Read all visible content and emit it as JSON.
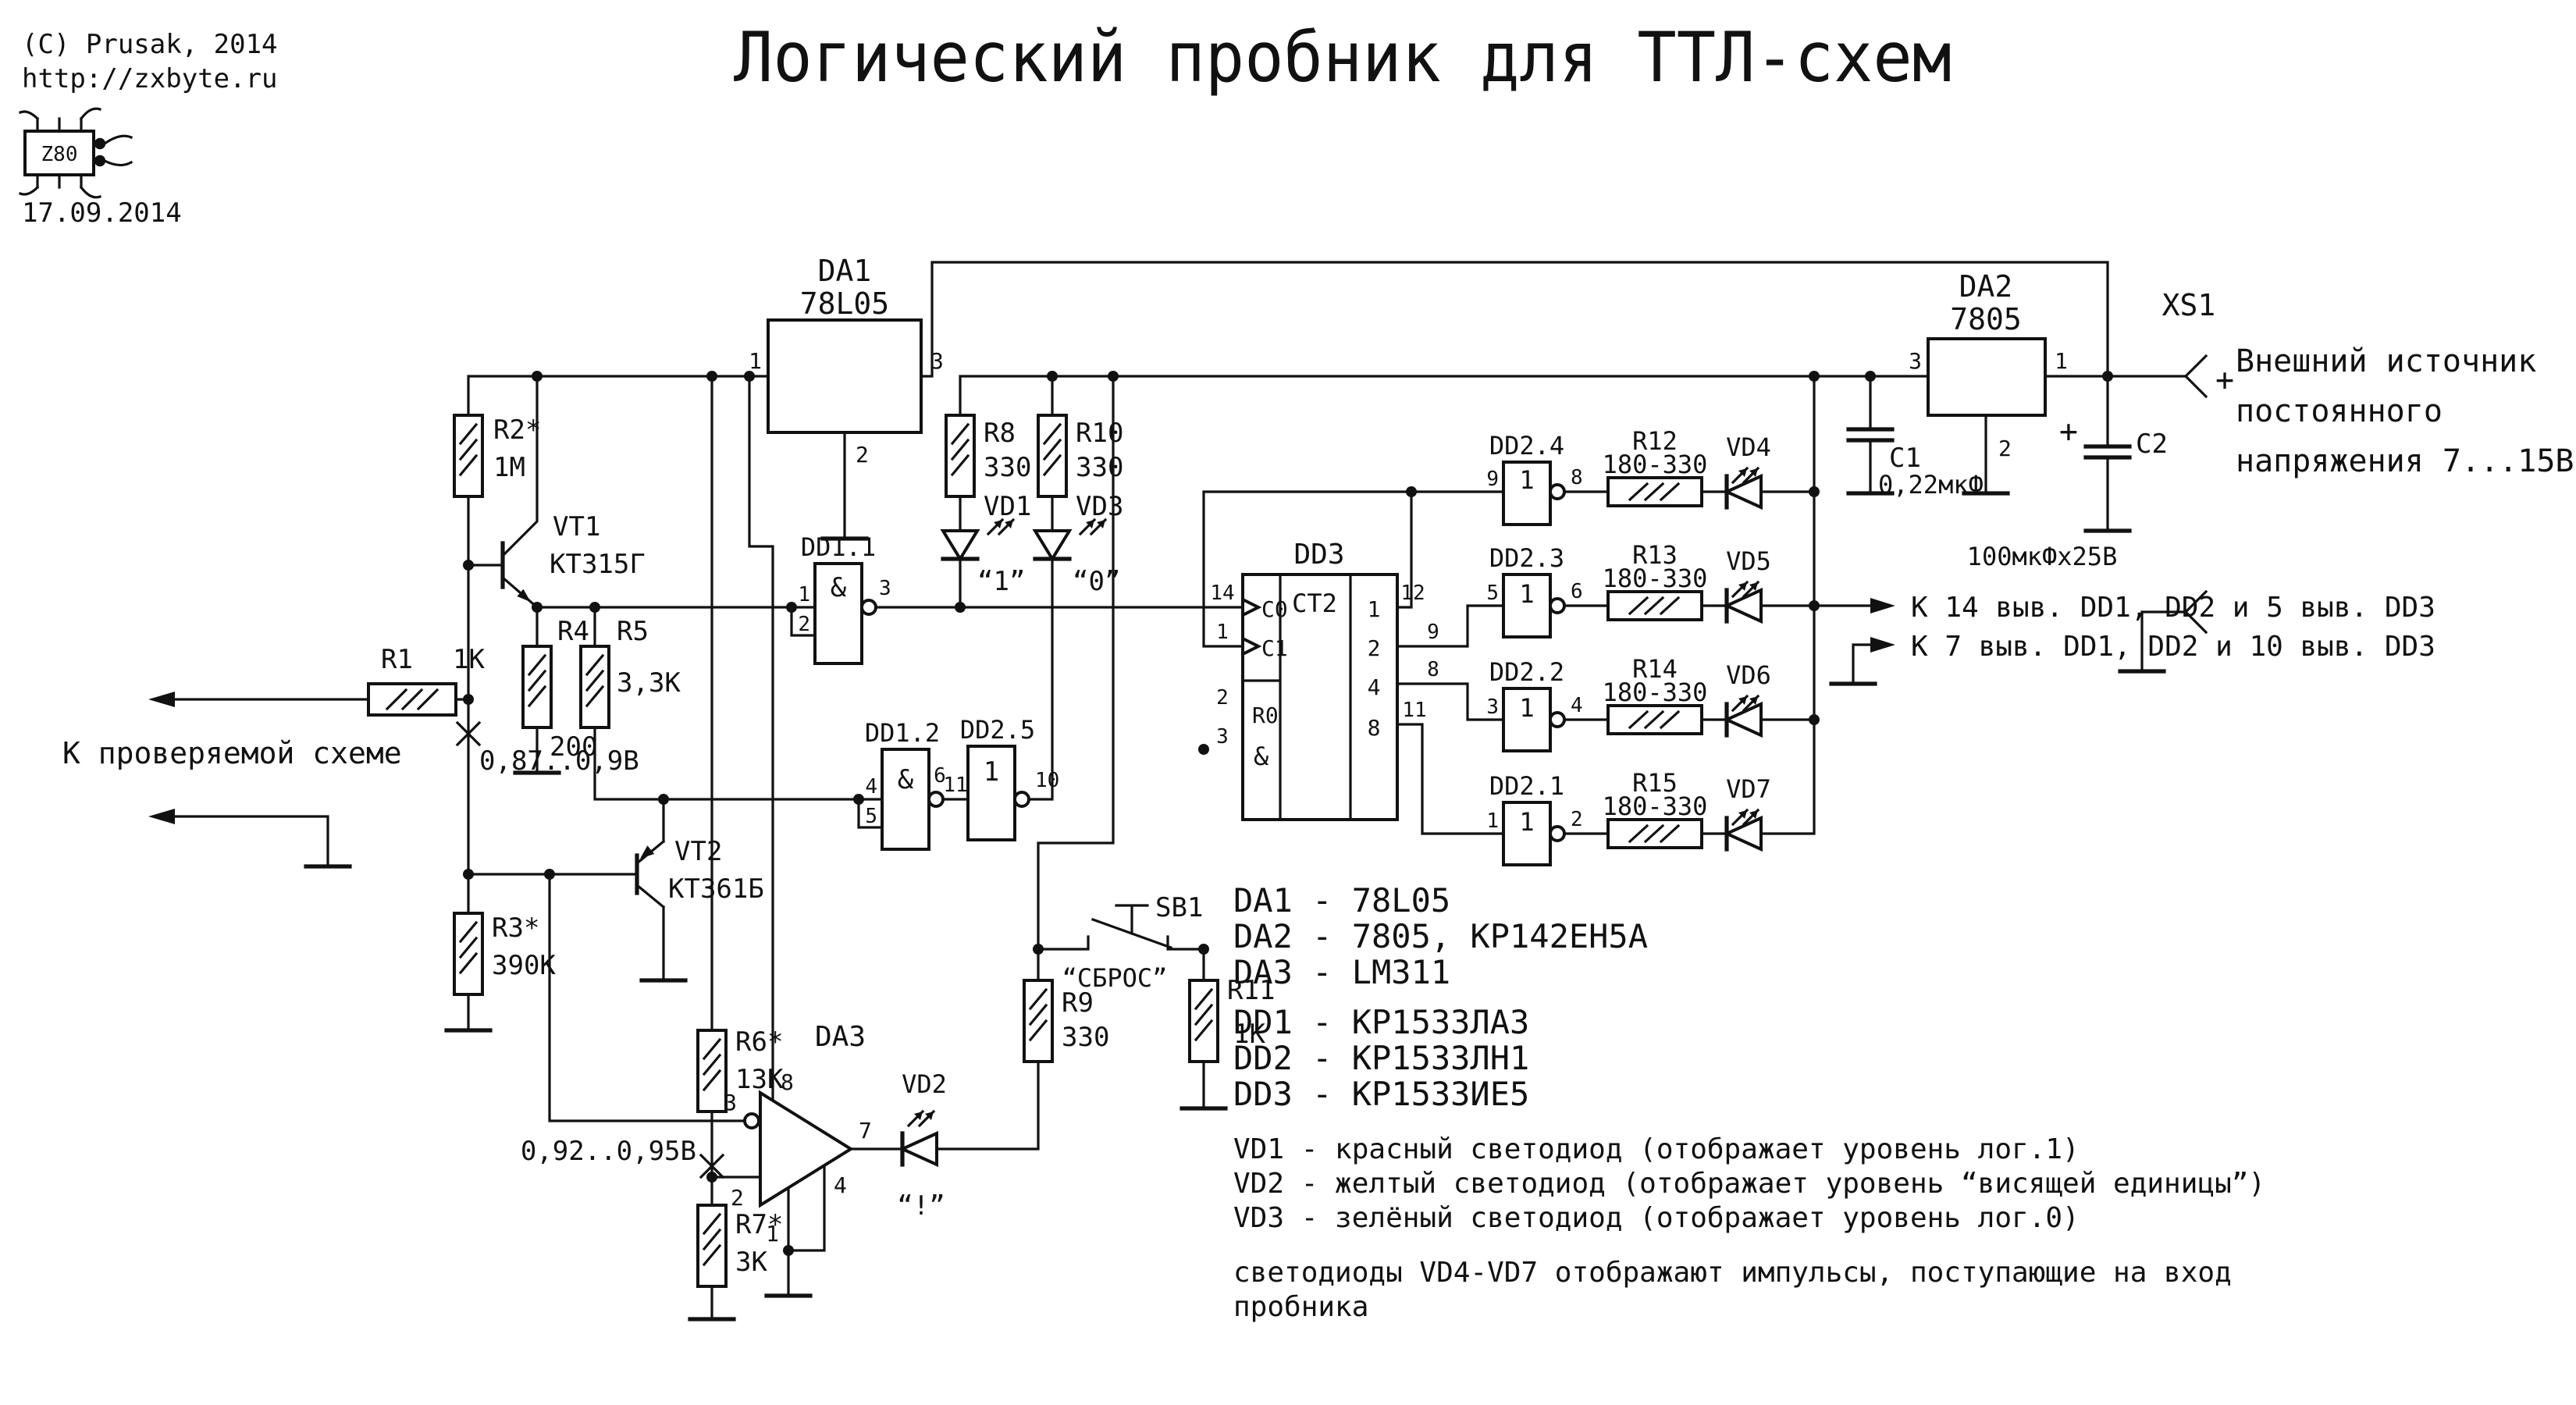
{
  "meta": {
    "copyright": "(C) Prusak, 2014",
    "url": "http://zxbyte.ru",
    "logo": "Z80",
    "date": "17.09.2014",
    "title": "Логический пробник для ТТЛ-схем"
  },
  "probe": {
    "to_circuit": "К проверяемой схеме",
    "r1": "R1",
    "r1_v": "1K",
    "v_base": "0,87..0,9В"
  },
  "front": {
    "r2": "R2*",
    "r2_v": "1М",
    "r3": "R3*",
    "r3_v": "390K",
    "r4": "R4",
    "r4_v": "200",
    "r5": "R5",
    "r5_v": "3,3K",
    "vt1": "VT1",
    "vt1_t": "КТ315Г",
    "vt2": "VT2",
    "vt2_t": "КТ361Б"
  },
  "da1": {
    "ref": "DA1",
    "part": "78L05",
    "p1": "1",
    "p2": "2",
    "p3": "3"
  },
  "da2": {
    "ref": "DA2",
    "part": "7805",
    "p1": "1",
    "p2": "2",
    "p3": "3"
  },
  "da3": {
    "ref": "DA3",
    "p1": "1",
    "p2": "2",
    "p3": "3",
    "p4": "4",
    "p7": "7",
    "p8": "8",
    "v_ref": "0,92..0,95В"
  },
  "caps": {
    "c1": "C1",
    "c1_v": "0,22мкФ",
    "c2": "C2",
    "c2_v": "100мкФх25В",
    "plus": "+"
  },
  "xs1": {
    "ref": "XS1",
    "plus": "+",
    "note1": "Внешний источник",
    "note2": "постоянного",
    "note3": "напряжения 7...15В"
  },
  "gates": {
    "dd11": "DD1.1",
    "dd12": "DD1.2",
    "dd25": "DD2.5",
    "dd24": "DD2.4",
    "dd23": "DD2.3",
    "dd22": "DD2.2",
    "dd21": "DD2.1",
    "and": "&",
    "inv": "1",
    "dd11_p1": "1",
    "dd11_p2": "2",
    "dd11_p3": "3",
    "dd12_p4": "4",
    "dd12_p5": "5",
    "dd12_p6": "6",
    "dd25_p11": "11",
    "dd25_p10": "10",
    "dd24_in": "9",
    "dd24_out": "8",
    "dd23_in": "5",
    "dd23_out": "6",
    "dd22_in": "3",
    "dd22_out": "4",
    "dd21_in": "1",
    "dd21_out": "2"
  },
  "dd3": {
    "ref": "DD3",
    "type": "CT2",
    "c0": "C0",
    "c1": "C1",
    "r0": "R0",
    "and": "&",
    "q1": "1",
    "q2": "2",
    "q4": "4",
    "q8": "8",
    "p14": "14",
    "p1": "1",
    "p2": "2",
    "p3": "3",
    "p12": "12",
    "p9": "9",
    "p8": "8",
    "p11": "11"
  },
  "leds": {
    "vd1": "VD1",
    "vd1_tag": "“1”",
    "vd2": "VD2",
    "vd2_tag": "“!”",
    "vd3": "VD3",
    "vd3_tag": "“0”",
    "vd4": "VD4",
    "vd5": "VD5",
    "vd6": "VD6",
    "vd7": "VD7"
  },
  "res": {
    "r6": "R6*",
    "r6_v": "13K",
    "r7": "R7*",
    "r7_v": "3K",
    "r8": "R8",
    "r8_v": "330",
    "r9": "R9",
    "r9_v": "330",
    "r10": "R10",
    "r10_v": "330",
    "r11": "R11",
    "r11_v": "1K",
    "r12": "R12",
    "r13": "R13",
    "r14": "R14",
    "r15": "R15",
    "r_range": "180-330"
  },
  "sb1": {
    "ref": "SB1",
    "tag": "“СБРОС”"
  },
  "supply_labels": {
    "vcc": "К 14 выв. DD1, DD2 и 5 выв. DD3",
    "gnd": "К 7 выв. DD1, DD2 и 10 выв. DD3"
  },
  "bom": {
    "l1": "DA1 - 78L05",
    "l2": "DA2 - 7805, КР142ЕН5А",
    "l3": "DA3 - LM311",
    "l4": "DD1 - КР1533ЛА3",
    "l5": "DD2 - КР1533ЛН1",
    "l6": "DD3 - КР1533ИЕ5",
    "l7": "VD1 - красный светодиод (отображает уровень лог.1)",
    "l8": "VD2 - желтый светодиод (отображает уровень “висящей единицы”)",
    "l9": "VD3 - зелёный светодиод (отображает уровень лог.0)",
    "l10": "светодиоды VD4-VD7 отображают импульсы, поступающие на вход",
    "l11": "пробника"
  }
}
